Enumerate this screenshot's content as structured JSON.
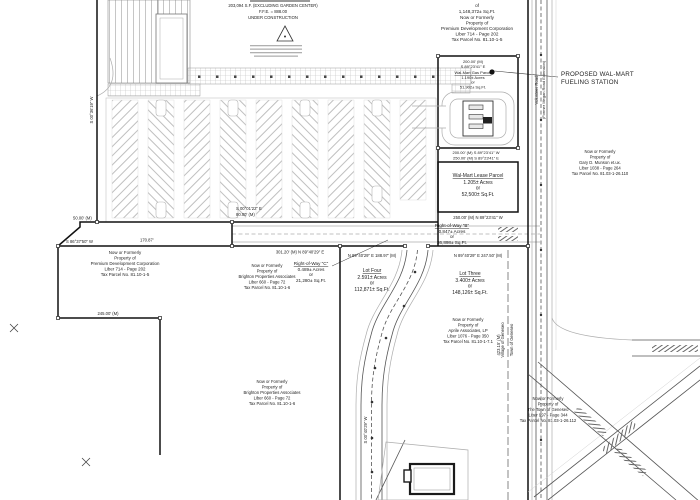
{
  "colors": {
    "ink": "#1c1c1c",
    "light": "#b9b9b9",
    "paper": "#ffffff"
  },
  "building": {
    "l1": "203,094 S.F. (EXCLUDING GARDEN CENTER)",
    "l2": "F.F.E. = 888.00",
    "l3": "UNDER CONSTRUCTION"
  },
  "callout": {
    "l1": "PROPOSED WAL-MART",
    "l2": "FUELING STATION"
  },
  "premiumTop": {
    "l0": "of",
    "l1": "1,148,372± Sq.Ft.",
    "l2": "Now or Formerly",
    "l3": "Property of",
    "l4": "Premium Development Corporation",
    "l5": "Liber 714 - Page 202",
    "l6": "Tax Parcel No. 81.10-1-5"
  },
  "gas": {
    "dim": "200.00' (M)",
    "brg": "S 89°23'41\" E",
    "l1": "Wal-Mart Gas Parcel",
    "l2": "1.190± Acres",
    "l3": "or",
    "l4": "51,902± Sq.Ft."
  },
  "lease": {
    "l1": "Wal-Mart Lease Parcel",
    "l2": "1.205± Acres",
    "l3": "or",
    "l4": "52,500± Sq.Ft."
  },
  "rowB": {
    "l1": "Right-of-Way \"B\"",
    "l2": "0.847± Acres",
    "l3": "or",
    "l4": "36,898± Sq.Ft."
  },
  "rowC": {
    "l1": "Right-of-Way \"C\"",
    "l2": "0.489± Acres",
    "l3": "or",
    "l4": "21,280± Sq.Ft."
  },
  "lotFour": {
    "l1": "Lot Four",
    "l2": "2.591± Acres",
    "l3": "or",
    "l4": "112,871± Sq.Ft."
  },
  "lotThree": {
    "l1": "Lot Three",
    "l2": "3.400± Acres",
    "l3": "or",
    "l4": "148,126± Sq.Ft."
  },
  "aprile": {
    "l1": "Now or Formerly",
    "l2": "Property of",
    "l3": "Aprile Associates, LP",
    "l4": "Liber 1076 - Page 350",
    "l5": "Tax Parcel No. 81.10-1-7.1"
  },
  "brighton": {
    "l1": "Now or Formerly",
    "l2": "Property of",
    "l3": "Brighton Properties Associates",
    "l4": "Liber 660 - Page 72",
    "l5": "Tax Parcel No. 81.10-1-6"
  },
  "premiumLeft": {
    "l1": "Now or Formerly",
    "l2": "Property of",
    "l3": "Premium Development Corporation",
    "l4": "Liber 714 - Page 202",
    "l5": "Tax Parcel No. 81.10-1-5"
  },
  "munson": {
    "l1": "Now or Formerly",
    "l2": "Property of",
    "l3": "Gary D. Munson et.ux.",
    "l4": "Liber 1038 - Page 264",
    "l5": "Tax Parcel No. 81.03-1-26.110"
  },
  "townGeneseo": {
    "l1": "Now or Formerly",
    "l2": "Property of",
    "l3": "The Town of Geneseo",
    "l4": "Liber 997 - Page 344",
    "l5": "Tax Parcel No. 81.03-1-26.112"
  },
  "dims": {
    "gasBottom": "200.00' (M)  S 89°23'41\" W",
    "leaseTop": "250.00' (M)  S 89°23'41\" E",
    "leaseBottom": "250.00' (M)  N 89°23'41\" W",
    "lotThreeTop": "N 89°40'29\" E   247.50' (M)",
    "lotFourTop": "N 89°40'29\" E   188.97' (M)",
    "corridor": "301.20' (M)   N 89°40'29\" E",
    "leftBearing": "S 86°37'50\" W",
    "leftLength": "170.87'",
    "premiumBottom": "245.00' (M)",
    "jogBearing": "S 00°01'22\" E",
    "jogLength": "80.00' (M)",
    "westJog": "50.00' (M)",
    "westRot": "S 00°36'19\" W",
    "eastRot": "423.15' (M)",
    "centerlineRot": "S 00°40'29\" W"
  },
  "roads": {
    "name1": "Volunteer Road",
    "name2": "(Former Megan Road Extension)",
    "muni1": "Town of Geneseo",
    "muni2": "Village of Geneseo"
  }
}
